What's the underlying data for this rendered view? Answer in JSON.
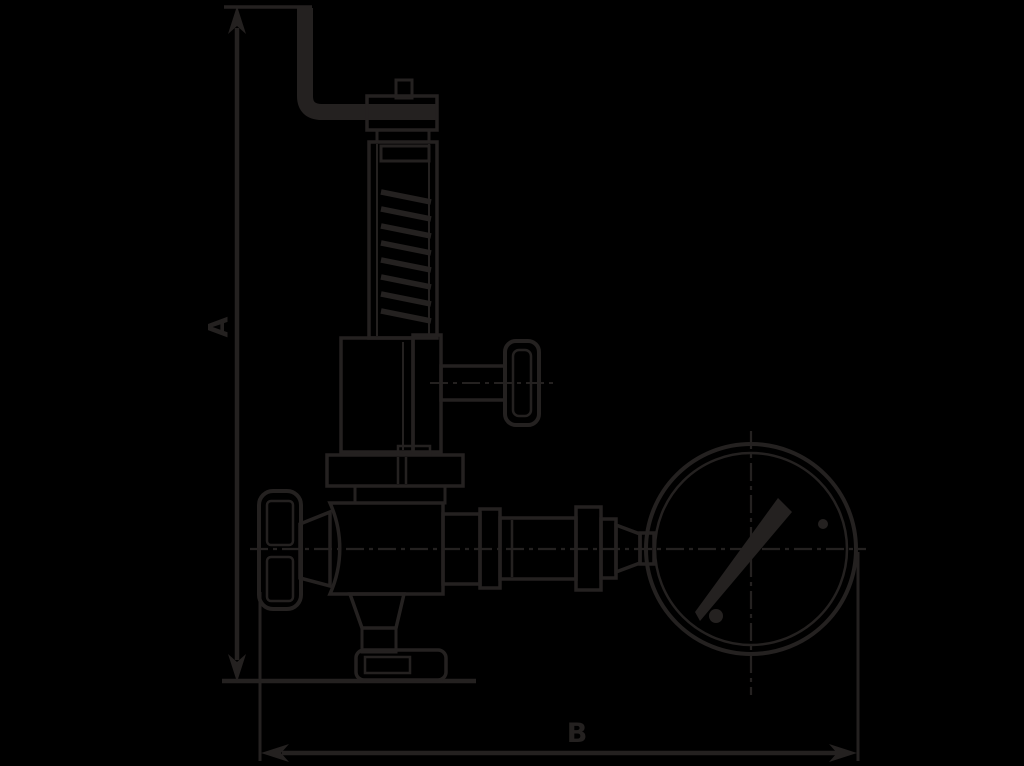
{
  "colors": {
    "bg": "#000000",
    "ink": "#242120"
  },
  "drawing": {
    "dim_a_label": "A",
    "dim_b_label": "B"
  }
}
